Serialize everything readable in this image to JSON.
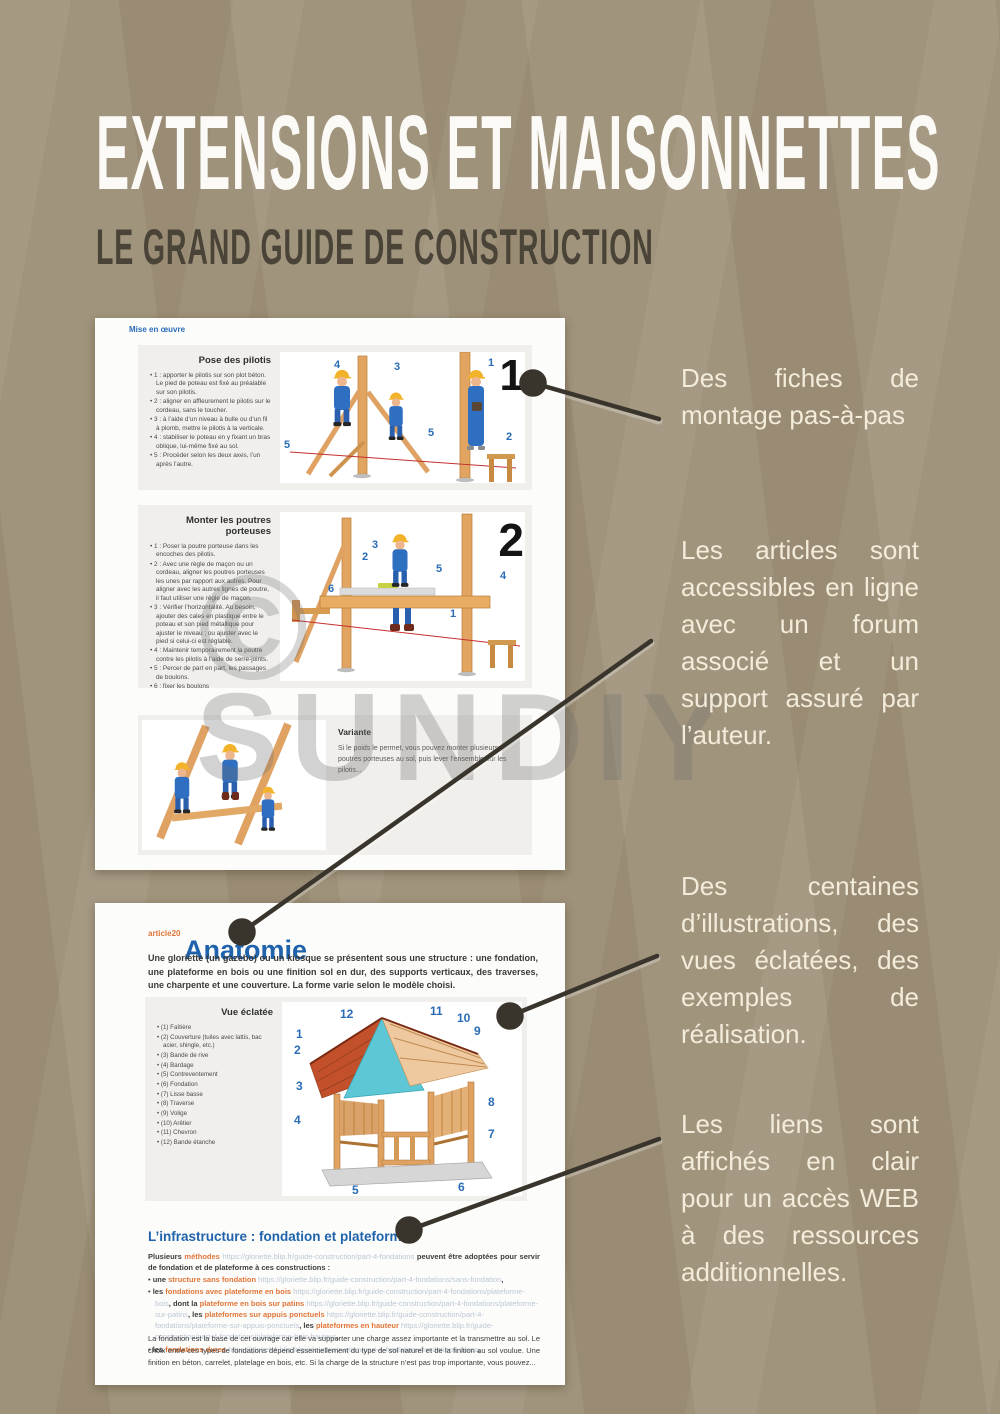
{
  "header": {
    "title": "EXTENSIONS ET MAISONNETTES",
    "subtitle": "LE GRAND GUIDE DE CONSTRUCTION"
  },
  "watermark": {
    "symbol": "©",
    "text": "SUNDIY"
  },
  "colors": {
    "background": "#9e9078",
    "panel": "#fcfcfa",
    "accent_blue": "#1f63ad",
    "accent_orange": "#e0763a",
    "url_text": "#bcc8d4",
    "callout_text": "#f3ecda",
    "connector": "#3a352c"
  },
  "callouts": [
    {
      "text": "Des fiches de montage pas-à-pas"
    },
    {
      "text": "Les articles sont accessibles en ligne avec un forum associé et un support assuré par l’auteur."
    },
    {
      "text": "Des centaines d’illustrations, des vues éclatées, des exemples de réalisation."
    },
    {
      "text": "Les liens sont affichés en clair pour un accès WEB à des ressources additionnelles."
    }
  ],
  "panel1": {
    "breadcrumb": "Mise en œuvre",
    "section1": {
      "title": "Pose des pilotis",
      "figure_number": "1",
      "labels": [
        "4",
        "3",
        "1",
        "5",
        "5",
        "2"
      ],
      "steps": [
        "1 : apporter le pilotis sur son plot béton. Le pied de poteau est fixé au préalable sur son pilotis.",
        "2 : aligner en affleurement le pilotis sur le cordeau, sans le toucher.",
        "3 : à l’aide d’un niveau à bulle ou d’un fil à plomb, mettre le pilotis à la verticale.",
        "4 : stabiliser le poteau en y fixant un bras oblique, lui-même fixé au sol.",
        "5 : Procéder selon les deux axes, l’un après l’autre."
      ]
    },
    "section2": {
      "title": "Monter les poutres porteuses",
      "figure_number": "2",
      "labels": [
        "3",
        "2",
        "6",
        "5",
        "4",
        "1"
      ],
      "steps": [
        "1 : Poser la poutre porteuse dans les encoches des pilotis.",
        "2 : Avec une règle de maçon ou un cordeau, aligner les poutres porteuses les unes par rapport aux autres. Pour aligner avec les autres lignes de poutre, il faut utiliser une règle de maçon.",
        "3 : Vérifier l’horizontalité. Au besoin, ajouter des cales en plastique entre le poteau et son pied métallique pour ajuster le niveau ; ou ajuster avec le pied si celui-ci est réglable.",
        "4 : Maintenir temporairement la poutre contre les pilotis à l’aide de serre-joints.",
        "5 : Percer de part en part, les passages de boulons.",
        "6 : fixer les boulons"
      ]
    },
    "variante": {
      "title": "Variante",
      "text": "Si le poids le permet, vous pouvez monter plusieurs poutres porteuses au sol, puis lever l’ensemble sur les pilotis..."
    }
  },
  "panel2": {
    "article_tag": "article20",
    "title": "Anatomie",
    "intro": "Une gloriette (un gazebo) ou un kiosque se présentent sous une structure : une fondation, une plateforme en bois ou une finition sol en dur, des supports verticaux, des traverses, une charpente et une couverture. La forme varie selon le modèle choisi.",
    "exploded": {
      "title": "Vue éclatée",
      "figure_labels": [
        "1",
        "2",
        "3",
        "4",
        "5",
        "6",
        "7",
        "8",
        "9",
        "10",
        "11",
        "12"
      ],
      "items": [
        "(1) Faîtière",
        "(2) Couverture (tuiles avec lattis, bac acier, shingle, etc.)",
        "(3) Bande de rive",
        "(4) Bardage",
        "(5) Contreventement",
        "(6) Fondation",
        "(7) Lisse basse",
        "(8) Traverse",
        "(9) Volige",
        "(10) Arêtier",
        "(11) Chevron",
        "(12) Bande étanche"
      ]
    },
    "infrastructure": {
      "title": "L’infrastructure : fondation et plateforme",
      "intro_runs": [
        {
          "t": "Plusieurs "
        },
        {
          "t": "méthodes "
        },
        {
          "t": "https://gloriette.blip.fr/guide-construction/part-4-fondations"
        },
        {
          "t": " peuvent être adoptées pour servir de fondation et de plateforme à ces constructions :"
        }
      ],
      "bullets": [
        {
          "runs": [
            {
              "t": "une "
            },
            {
              "t": "structure sans fondation "
            },
            {
              "t": "https://gloriette.blip.fr/guide-construction/part-4-fondations/sans-fondation"
            },
            {
              "t": ","
            }
          ]
        },
        {
          "runs": [
            {
              "t": "les "
            },
            {
              "t": "fondations avec plateforme en bois "
            },
            {
              "t": "https://gloriette.blip.fr/guide-construction/part-4-fondations/plateforme-bois"
            },
            {
              "t": ", "
            },
            {
              "t": "dont la "
            },
            {
              "t": "plateforme en bois sur patins "
            },
            {
              "t": "https://gloriette.blip.fr/guide-construction/part-4-fondations/plateforme-sur-patins"
            },
            {
              "t": ", "
            },
            {
              "t": "les "
            },
            {
              "t": "plateformes sur appuis ponctuels "
            },
            {
              "t": "https://gloriette.blip.fr/guide-construction/part-4-fondations/plateforme-sur-appuis-ponctuels"
            },
            {
              "t": ", "
            },
            {
              "t": "les "
            },
            {
              "t": "plateformes en hauteur "
            },
            {
              "t": "https://gloriette.blip.fr/guide-construction/part-4-fondations/plateforme-bois-hauteur"
            },
            {
              "t": ","
            }
          ]
        },
        {
          "runs": [
            {
              "t": "les "
            },
            {
              "t": "fondations dures "
            },
            {
              "t": "https://gloriette.blip.fr/guide-construction/part-4-fondations/fondations-dures"
            },
            {
              "t": ","
            }
          ]
        }
      ],
      "outro": "La fondation est la base de cet ouvrage car elle va supporter une charge assez importante et la transmettre au sol. Le choix entre ces types de fondations dépend essentiellement du type de sol naturel et de la finition au sol voulue. Une finition en béton, carrelet, platelage en bois, etc. Si la charge de la structure n’est pas trop importante, vous pouvez..."
    }
  }
}
